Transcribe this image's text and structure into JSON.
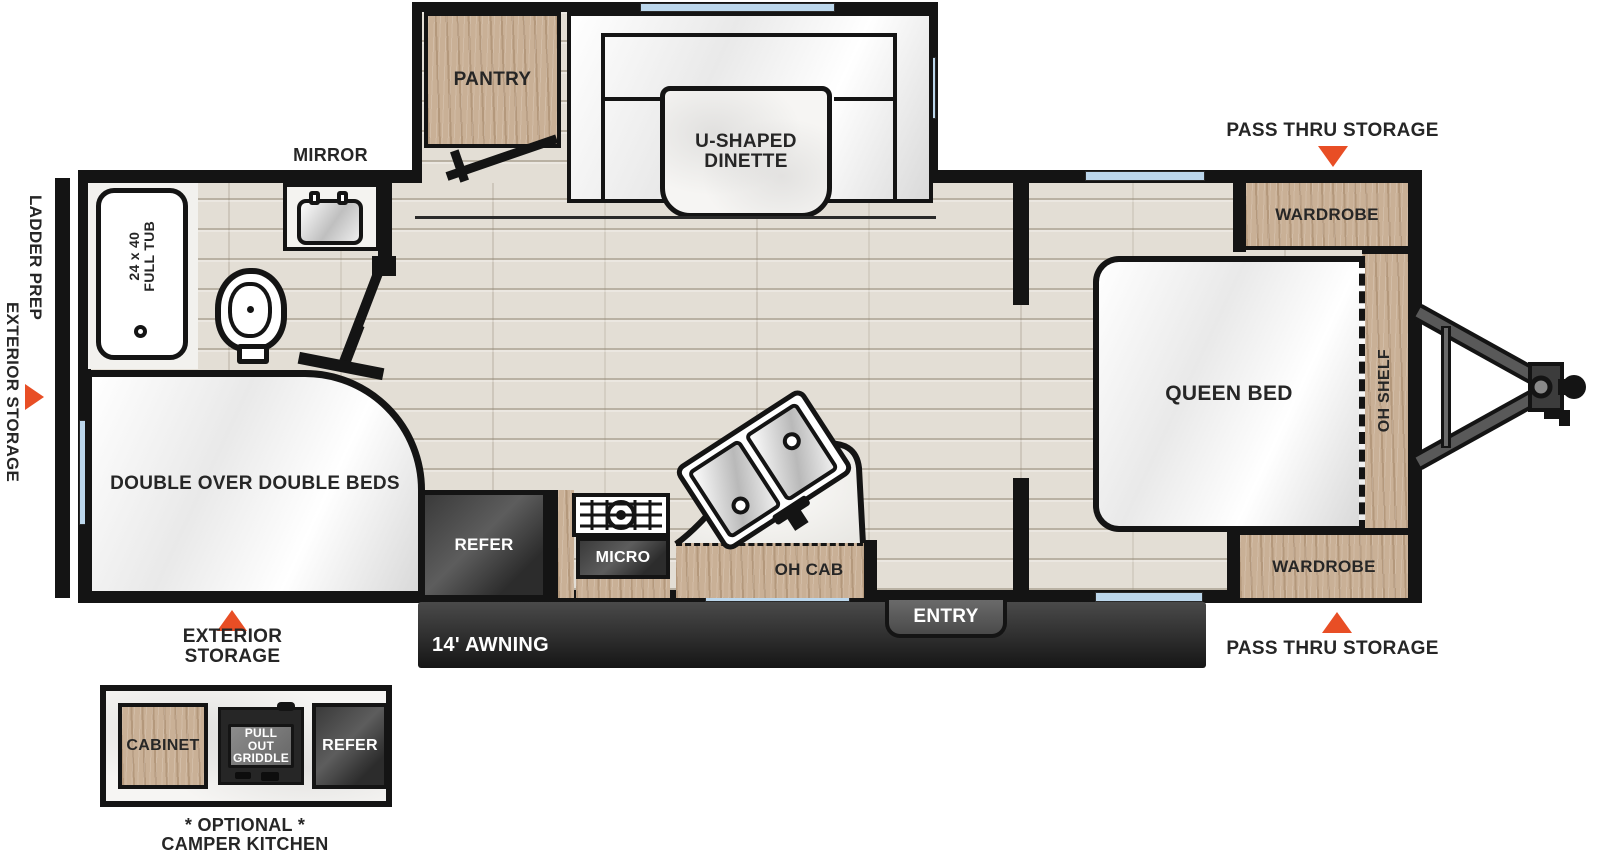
{
  "colors": {
    "accent_orange": "#e84e25",
    "wall_black": "#141414",
    "wood": "#c9b096",
    "floor": "#e3ded5",
    "appliance_gray": "#474747",
    "window_blue": "#bcd7ec",
    "marble_white": "#f6f5f3"
  },
  "exterior": {
    "pass_thru_storage_top": "PASS THRU STORAGE",
    "pass_thru_storage_bottom": "PASS THRU STORAGE",
    "ladder_prep": "LADDER PREP",
    "exterior_storage_left": "EXTERIOR STORAGE",
    "exterior_storage_bottom": "EXTERIOR STORAGE",
    "awning": "14' AWNING",
    "entry": "ENTRY",
    "mirror": "MIRROR"
  },
  "bedroom": {
    "queen_bed": "QUEEN BED",
    "wardrobe_top": "WARDROBE",
    "wardrobe_bottom": "WARDROBE",
    "oh_shelf": "OH SHELF"
  },
  "dinette": {
    "line1": "U-SHAPED",
    "line2": "DINETTE",
    "pantry": "PANTRY"
  },
  "bathroom": {
    "tub_line1": "24 x 40",
    "tub_line2": "FULL TUB"
  },
  "bunk": {
    "label": "DOUBLE OVER DOUBLE BEDS"
  },
  "kitchen": {
    "refer": "REFER",
    "micro": "MICRO",
    "oh_cab": "OH CAB"
  },
  "camper_kitchen": {
    "cabinet": "CABINET",
    "griddle_line1": "PULL OUT",
    "griddle_line2": "GRIDDLE",
    "refer": "REFER",
    "optional": "* OPTIONAL *",
    "title": "CAMPER KITCHEN"
  }
}
